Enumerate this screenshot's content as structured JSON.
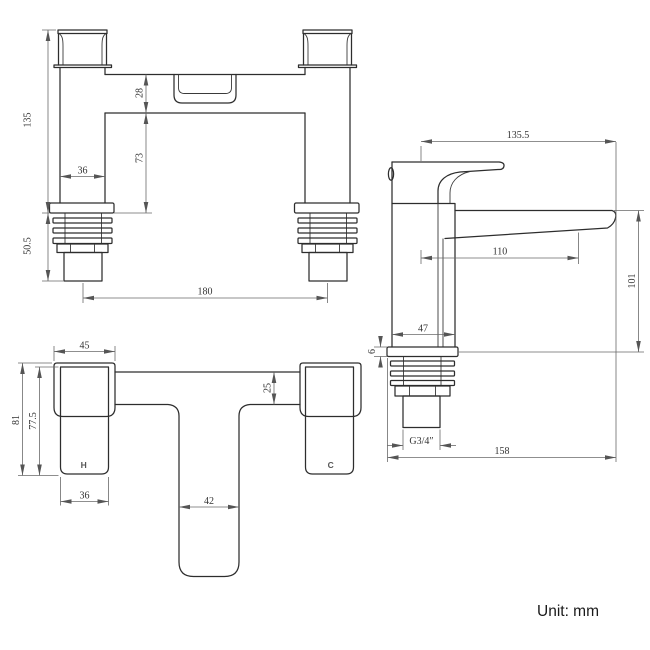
{
  "drawing": {
    "unit_note": "Unit: mm",
    "front_view": {
      "dims": {
        "total_height": "135",
        "tail_height": "50.5",
        "bar_height": "28",
        "bar_to_base": "73",
        "pillar_width": "36",
        "inlet_centres": "180"
      }
    },
    "side_view": {
      "dims": {
        "overall_projection": "135.5",
        "spout_projection": "110",
        "spout_height": "101",
        "body_depth": "47",
        "flange_thickness": "6",
        "inlet_thread": "G3/4″",
        "overall_depth": "158"
      }
    },
    "plan_view": {
      "dims": {
        "handle_depth": "45",
        "bar_depth": "25",
        "overall_depth": "81",
        "body_depth": "77.5",
        "body_width": "36",
        "spout_width": "42"
      },
      "hot_label": "H",
      "cold_label": "C"
    },
    "colors": {
      "line": "#2d2d2d",
      "dimension": "#6a6a6a",
      "background": "#ffffff"
    }
  }
}
